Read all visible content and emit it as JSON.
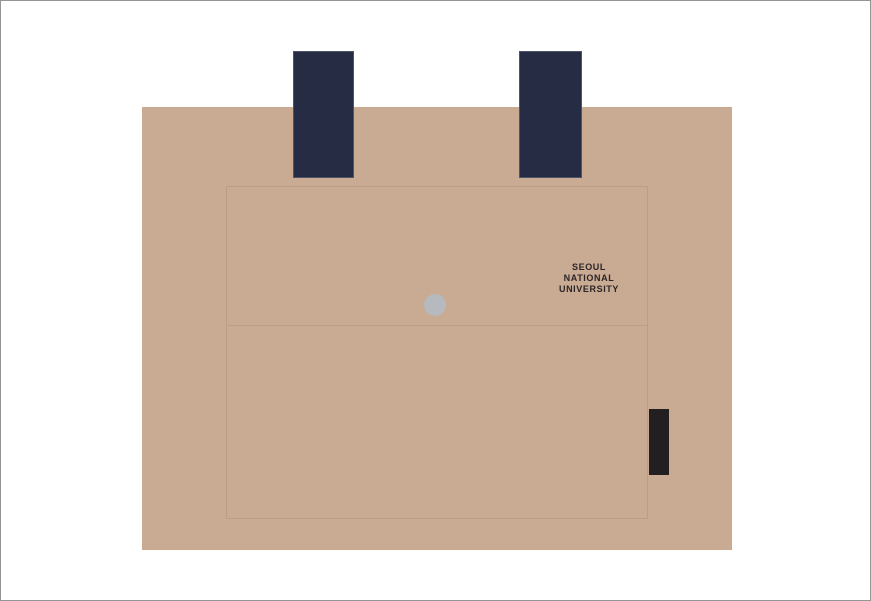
{
  "title": "Tote bag mockup",
  "logo": {
    "line1": "SEOUL",
    "line2": "NATIONAL",
    "line3": "UNIVERSITY"
  },
  "colors": {
    "background": "#ffffff",
    "canvas_border": "#959595",
    "bag_body": "#c9aa93",
    "panel_line": "#bc9e87",
    "strap": "#262c43",
    "strap_border": "#4d5368",
    "snap": "#b6babe",
    "tag": "#231f20",
    "logo_text": "#2b2526"
  }
}
